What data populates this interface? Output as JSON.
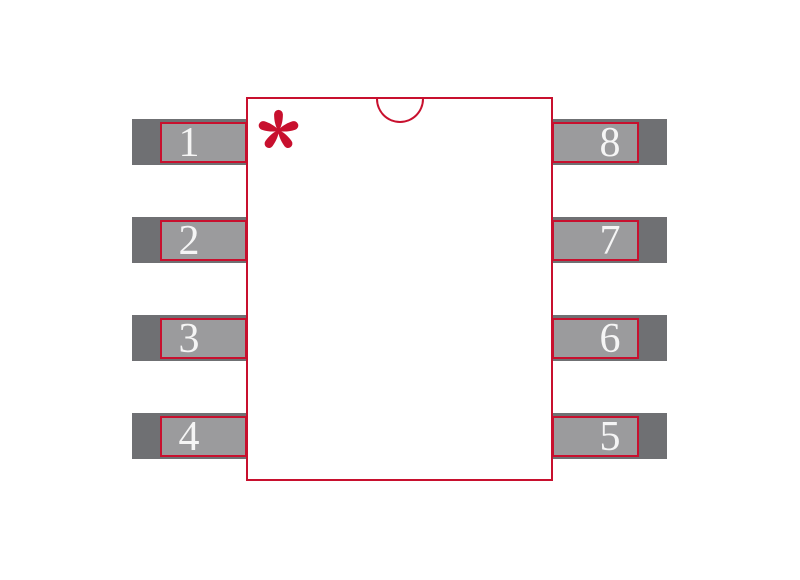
{
  "figure": {
    "type": "ic-footprint-diagram",
    "pin_count": 8,
    "pin1_marker": "asterisk",
    "pin1_indicator": "top-center-notch"
  },
  "colors": {
    "red": "#c8102e",
    "pad-dark": "#6f7073",
    "pad-light": "#9b9b9d",
    "num": "#f5f5f5",
    "bg": "#ffffff"
  },
  "pads": {
    "left": [
      {
        "number": "1"
      },
      {
        "number": "2"
      },
      {
        "number": "3"
      },
      {
        "number": "4"
      }
    ],
    "right": [
      {
        "number": "8"
      },
      {
        "number": "7"
      },
      {
        "number": "6"
      },
      {
        "number": "5"
      }
    ]
  }
}
